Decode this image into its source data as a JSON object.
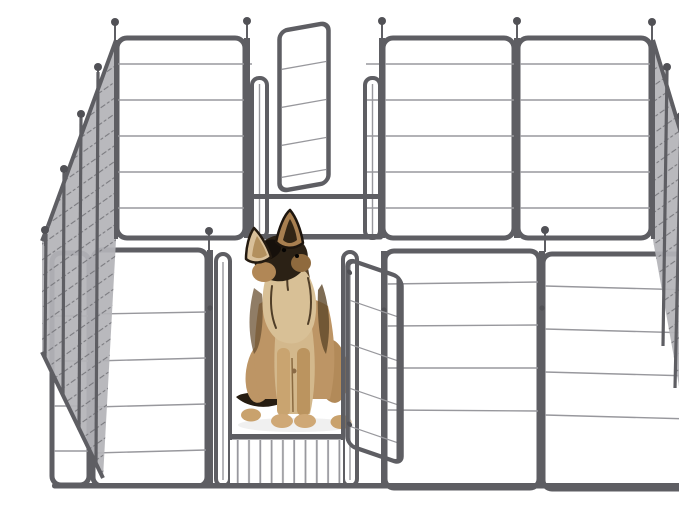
{
  "meta": {
    "alt": "Product photo: a German Shepherd puppy sitting inside a gray heavy-duty metal wire dog playpen with an open back gate and an open front gate, on a plain white background"
  },
  "scene": {
    "product": "heavy-duty metal dog playpen",
    "subject": "German Shepherd puppy",
    "subject_pose": "sitting upright facing viewer, head tilted up and to the left",
    "panels_visible": {
      "back_wall": 4,
      "left_side_wall": 4,
      "right_side_wall": 4,
      "front_wall": 4
    },
    "gates": [
      {
        "location": "back wall",
        "state": "open, swung inward"
      },
      {
        "location": "front wall",
        "state": "open, swung outward"
      }
    ],
    "details": [
      "ball-topped locking pins at panel junctions",
      "raised threshold bar in each gate panel",
      "white seamless studio background"
    ]
  },
  "colors": {
    "bg": "#ffffff",
    "frame": "#5e5e63",
    "wire": "#98989d",
    "wireLight": "#bcbcc0",
    "mesh": "#b4b4b8",
    "hatch": "#6f6f74",
    "ball": "#515156",
    "dog": {
      "tan": "#bd9565",
      "tanLight": "#d3b88c",
      "tanPale": "#d9c09a",
      "tanDeep": "#a77e4e",
      "cream": "#d8c096",
      "black": "#16100b",
      "darkBrown": "#322515",
      "midBrown": "#6b5233",
      "nose": "#0a0807"
    }
  }
}
